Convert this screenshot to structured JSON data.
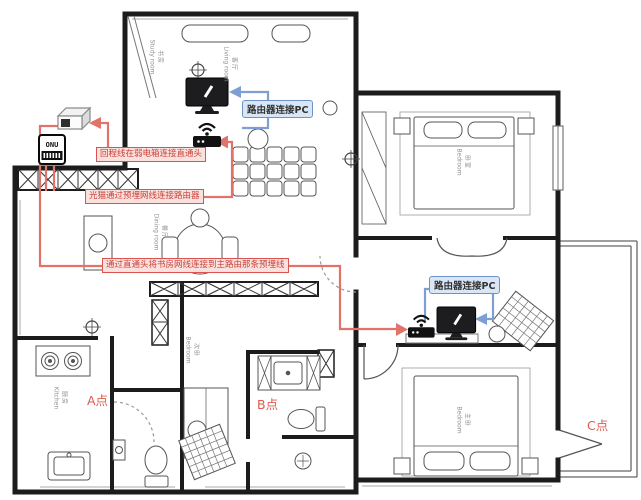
{
  "annotations": {
    "red": [
      "回程线在弱电箱连接直通头",
      "光猫通过预埋网线连接路由器",
      "通过直通头将书房网线连接到主路由那条预埋线"
    ],
    "blue": [
      "路由器连接PC",
      "路由器连接PC"
    ],
    "points": [
      "A点",
      "B点",
      "C点"
    ]
  },
  "devices": {
    "onu_label": "ONU"
  },
  "rooms": [
    {
      "zh": "书房",
      "en": "Study room"
    },
    {
      "zh": "客厅",
      "en": "Living room"
    },
    {
      "zh": "餐厅",
      "en": "Dining room"
    },
    {
      "zh": "厨房",
      "en": "Kitchen"
    },
    {
      "zh": "次卧",
      "en": "Bedroom"
    },
    {
      "zh": "卧室",
      "en": "Bedroom"
    },
    {
      "zh": "主卧",
      "en": "Bedroom"
    }
  ],
  "colors": {
    "annotation_red": "#d9534f",
    "annotation_red_bg": "#fae1de",
    "annotation_blue": "#6d92c9",
    "annotation_blue_bg": "#d8e6f6",
    "wall": "#1c1c1c"
  }
}
